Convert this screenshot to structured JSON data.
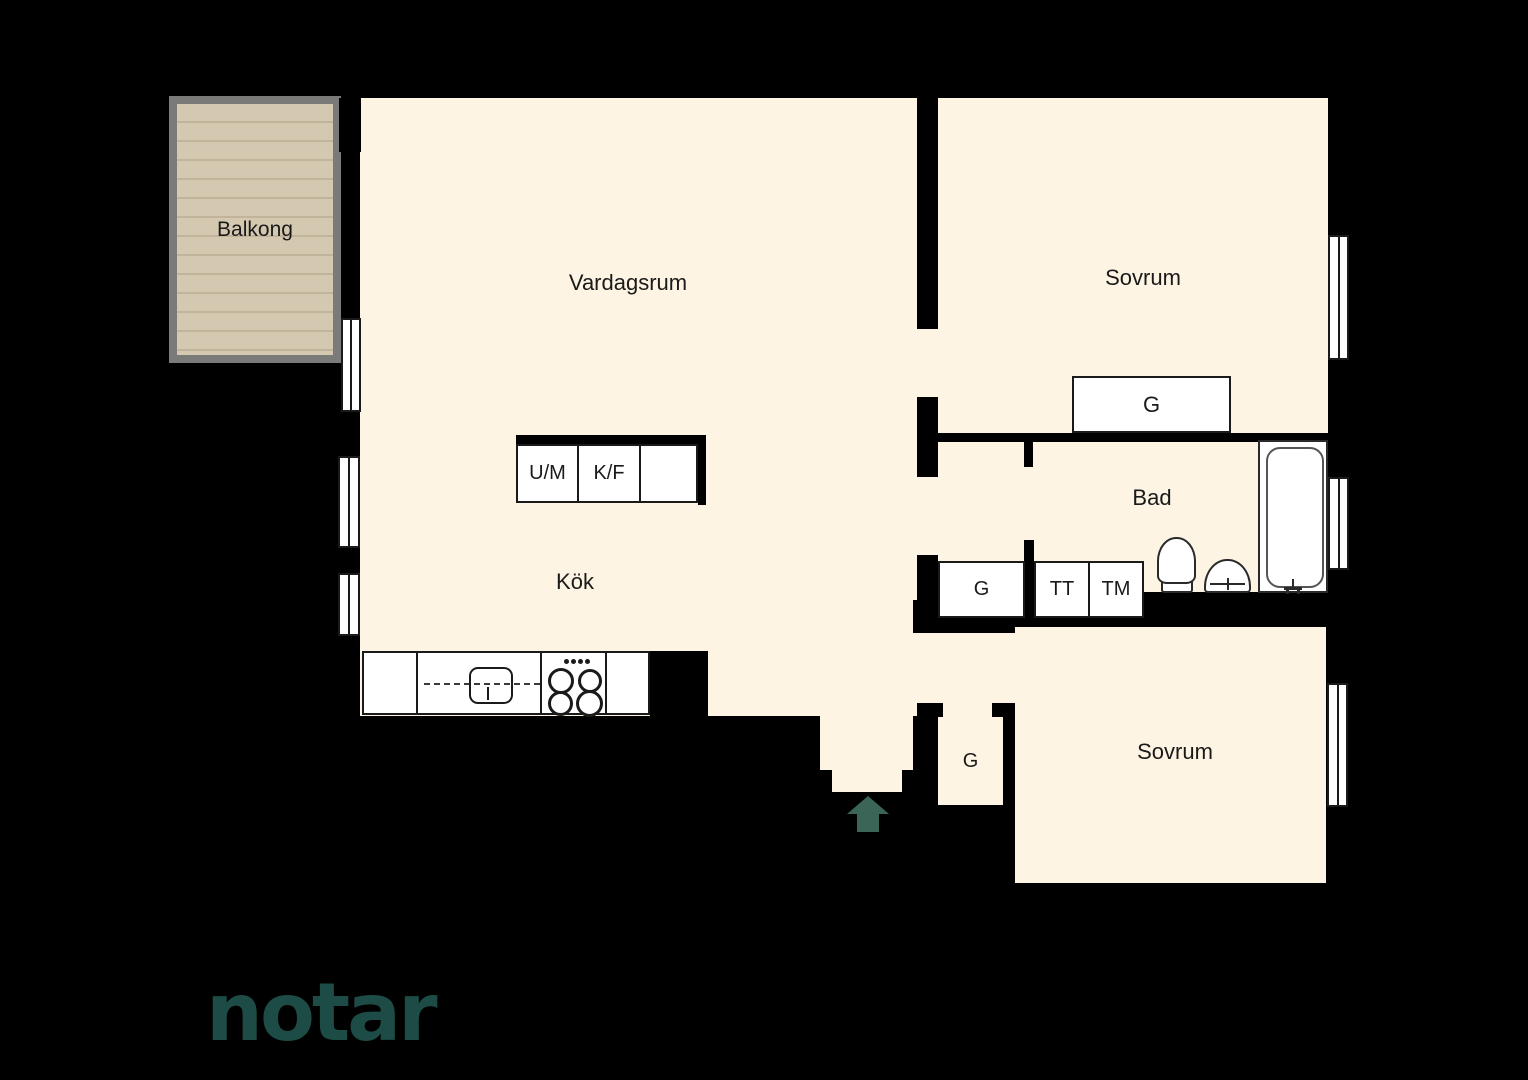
{
  "rooms": {
    "balkong": "Balkong",
    "vardagsrum": "Vardagsrum",
    "sovrum_top": "Sovrum",
    "kok": "Kök",
    "bad": "Bad",
    "sovrum_bottom": "Sovrum"
  },
  "closets": {
    "g_sovrum": "G",
    "g_bad": "G",
    "tt": "TT",
    "tm": "TM",
    "g_hall": "G"
  },
  "appliances": {
    "um": "U/M",
    "kf": "K/F"
  },
  "colors": {
    "background": "#000000",
    "floor": "#fdf4e3",
    "fixture_fill": "#ffffff",
    "fixture_outline": "#1a1a1a",
    "balcony_deck": "#d5c8b1",
    "balcony_stripe": "#c2b49a",
    "balcony_frame": "#7a7a78",
    "entrance_arrow": "#3b6557",
    "logo": "#1d4b45"
  },
  "logo": {
    "text": "notar"
  }
}
